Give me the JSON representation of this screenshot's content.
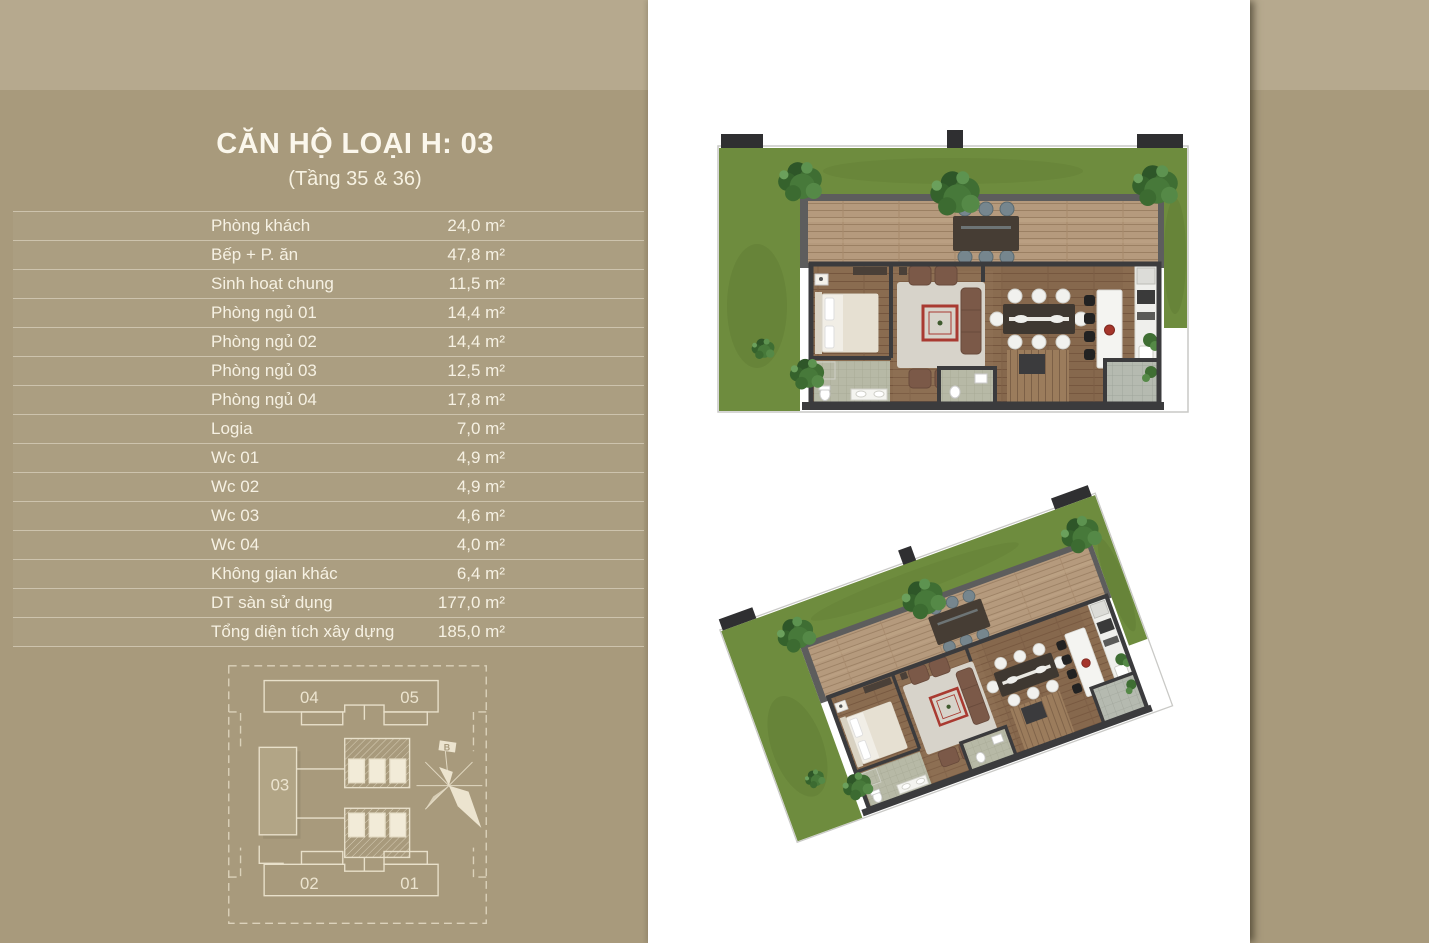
{
  "page": {
    "colors": {
      "background": "#a89a7c",
      "top_band": "#b6a98e",
      "panel": "#ffffff",
      "text_cream": "#f6f1e3",
      "keyplan_line": "#ece4cf",
      "unit_highlight_fill": "#b3a687",
      "accent_red": "#a93a31",
      "lawn_green": "#6e8c3e",
      "deck_wood": "#b59a7d",
      "floor_wood": "#8a6c50",
      "wall_dark": "#3b3b3d"
    }
  },
  "header": {
    "title": "CĂN HỘ LOẠI H: 03",
    "subtitle": "(Tầng 35 & 36)"
  },
  "area_table": {
    "rows": [
      {
        "label": "Phòng khách",
        "area": "24,0 m²"
      },
      {
        "label": "Bếp + P. ăn",
        "area": "47,8 m²"
      },
      {
        "label": "Sinh hoạt chung",
        "area": "11,5 m²"
      },
      {
        "label": "Phòng ngủ 01",
        "area": "14,4 m²"
      },
      {
        "label": "Phòng ngủ 02",
        "area": "14,4 m²"
      },
      {
        "label": "Phòng ngủ 03",
        "area": "12,5 m²"
      },
      {
        "label": "Phòng ngủ 04",
        "area": "17,8 m²"
      },
      {
        "label": "Logia",
        "area": "7,0 m²"
      },
      {
        "label": "Wc 01",
        "area": "4,9 m²"
      },
      {
        "label": "Wc 02",
        "area": "4,9 m²"
      },
      {
        "label": "Wc 03",
        "area": "4,6 m²"
      },
      {
        "label": "Wc 04",
        "area": "4,0 m²"
      },
      {
        "label": "Không gian khác",
        "area": "6,4 m²"
      },
      {
        "label": "DT sàn sử dụng",
        "area": "177,0 m²"
      },
      {
        "label": "Tổng diện tích xây dựng",
        "area": "185,0 m²"
      }
    ]
  },
  "keyplan": {
    "units": [
      {
        "label": "04",
        "highlighted": false
      },
      {
        "label": "05",
        "highlighted": false
      },
      {
        "label": "03",
        "highlighted": true
      },
      {
        "label": "02",
        "highlighted": false
      },
      {
        "label": "01",
        "highlighted": false
      }
    ],
    "compass_label": "B"
  }
}
